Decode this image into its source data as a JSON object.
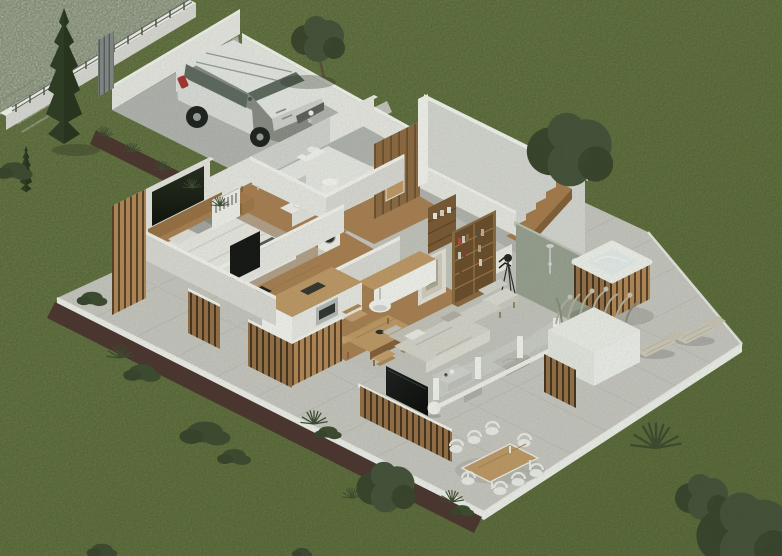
{
  "scene": {
    "title": "3D isometric cutaway floor plan render of a modern single-story villa with garden, terrace and driveway",
    "style": "photorealistic architectural visualization, top-down isometric view",
    "environment": {
      "ground": "green lawn",
      "street_corner": "top-left, light concrete with sidewalk pavers",
      "boundary": "white wall with thin metal fence on top",
      "driveway": "concrete, walled carport with gray slatted gate",
      "vehicle": "white SUV parked facing the house",
      "garden_borders": "dark mulch strips planted with shrubs and grasses"
    },
    "rooms": [
      {
        "name": "bedroom",
        "items": [
          "double bed with white duvet and gray pillows",
          "wood headboard",
          "dark feature wall panel",
          "nightstand with lamp",
          "open wardrobe with clothes",
          "wall mounted tv"
        ]
      },
      {
        "name": "bathroom",
        "items": [
          "marble walk-in shower",
          "vanity sink with mirror",
          "cylindrical water heater",
          "washing machine",
          "towel shelf"
        ]
      },
      {
        "name": "hallway",
        "items": [
          "wood wall paneling",
          "entry door"
        ]
      },
      {
        "name": "walk-in closet / study",
        "items": [
          "wood shelving niche",
          "tall bookshelf with books",
          "layered square framed artwork",
          "chevron artwork",
          "reading armchair",
          "tripod floor lamp"
        ]
      },
      {
        "name": "second bedroom / office",
        "items": [
          "dark desk",
          "dark chair"
        ]
      },
      {
        "name": "kitchen",
        "items": [
          "white island with wood countertop",
          "back counter",
          "built-in oven",
          "black cooktop",
          "white pendant lamp"
        ]
      },
      {
        "name": "dining area",
        "items": [
          "wood dining table",
          "5 wicker chairs",
          "black centerpiece bowl"
        ]
      },
      {
        "name": "living room",
        "items": [
          "light gray sectional sofa",
          "gray lounge pouf",
          "2 gray coffee tables",
          "tv on slatted wood media wall",
          "white ball floor lamp"
        ]
      },
      {
        "name": "staircase hall",
        "items": [
          "wood staircase",
          "tall white walls",
          "exterior wood cladding"
        ]
      }
    ],
    "outdoor": {
      "terrace": "large light gray tiled patio with white curb",
      "hot_tub": "square spa, white rim, wood slat cladding",
      "outdoor_shower": {
        "wall": "green-gray concrete",
        "shower_heads": 2
      },
      "sun_loungers": 2,
      "pampas_planter": "white planter with dry ornamental grasses and wood slat screen",
      "outdoor_dining": {
        "table": "wood top with white frame",
        "white_chairs": 8
      },
      "privacy_screens": "vertical wood slat fences",
      "trees": [
        "tall italian cypress",
        "small cypress",
        "olive tree",
        "garden tree right of house",
        "conifer shrub",
        "two trees bottom-right"
      ],
      "shrubs": "multiple dark green bushes and spiky grasses"
    }
  },
  "palette": {
    "grass_light": "#7d8a57",
    "grass_dark": "#6b7947",
    "street": "#d3d4d2",
    "sidewalk_line": "#c2c3c0",
    "wall_top": "#f7f7f5",
    "wall_face": "#ebebe8",
    "wall_shade": "#deddda",
    "terrace": "#cac9c5",
    "tile_line": "#b7b7b3",
    "curb": "#f2f3f1",
    "walkway": "#c6c6c2",
    "mulch": "#4b3330",
    "driveway": "#b5b7b5",
    "carport_gate": "#5f6566",
    "concrete_wall": "#9aa294",
    "tall_room_wall": "#d9d9d7",
    "tall_room_floor": "#b6b6b4",
    "wood": "#a97c4e",
    "wood_dark": "#85603a",
    "wood_light": "#c29a68",
    "floor_wood": "#ab8054",
    "floor_gray": "#c7c6c2",
    "bath_floor": "#ebebe9",
    "marble": "#d4d6d5",
    "sofa": "#d9d6d0",
    "sofa_shade": "#c9c6c0",
    "pouf": "#b7b3ac",
    "tv_black": "#121315",
    "bed_linen": "#edece8",
    "pillow_gray": "#a9a8a5",
    "throw_dark": "#565a5e",
    "headboard": "#9c7146",
    "feature_panel": "#141a10",
    "rug": "#c2c0bb",
    "tub_white": "#f3f4f2",
    "tub_water": "#e9eff1",
    "lounger": "#d2ccbf",
    "outdoor_chair": "#eef0ee",
    "wicker": "#c8a070",
    "chrome": "#c6cbcb",
    "lamp_black": "#2a2b2c",
    "cypress": "#2c3a24",
    "tree_green": "#44513a",
    "tree_green_dark": "#37432c",
    "bush": "#3c4a31",
    "car_body": "#e9ebe9",
    "car_glass": "#5f6a62",
    "car_tire": "#1d1f1f",
    "taillight_red": "#a83232",
    "shadow": "rgba(30,34,24,0.28)"
  }
}
